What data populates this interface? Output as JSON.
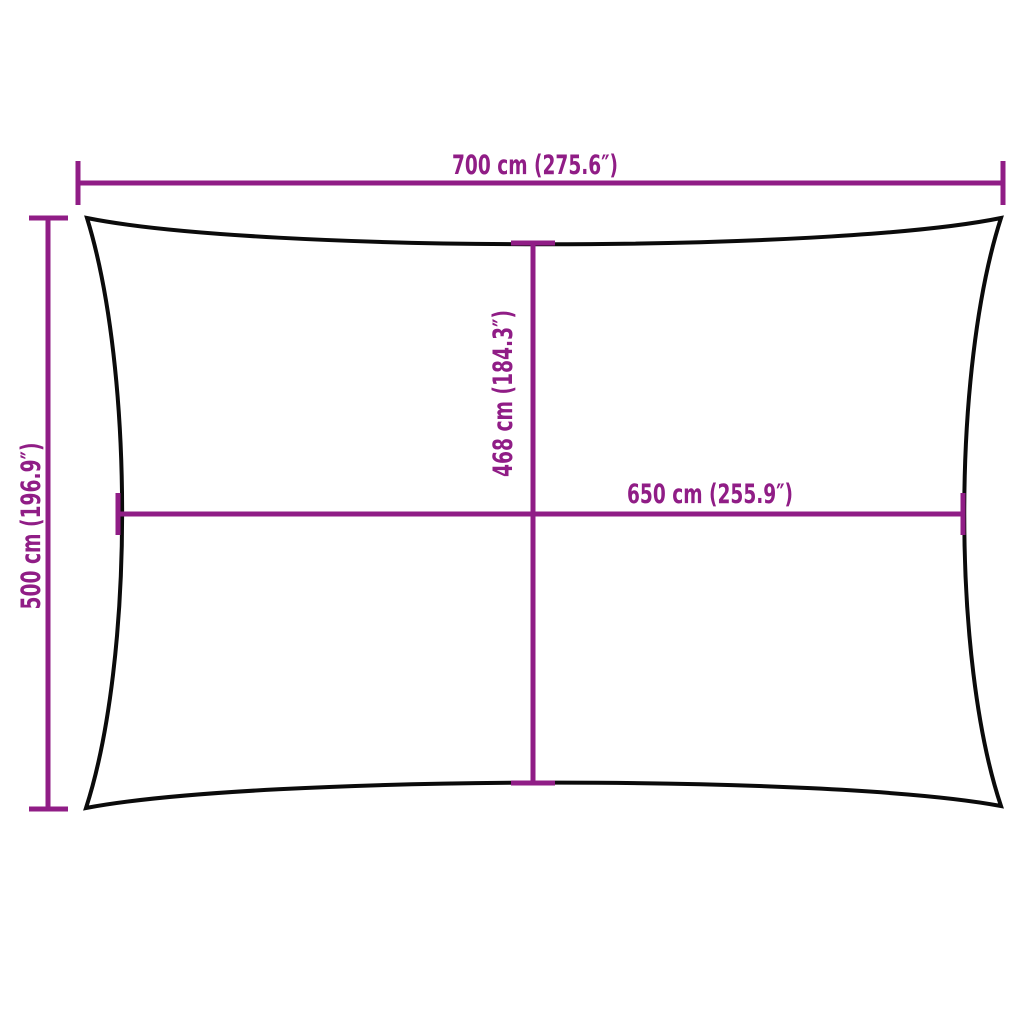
{
  "page": {
    "background": "#ffffff"
  },
  "diagram": {
    "type": "product-dimension-diagram",
    "subject": "rectangular shade sail outline with concave edges",
    "colors": {
      "dimension_lines": "#901d86",
      "sail_outline": "#0b0b0b",
      "background": "#ffffff"
    },
    "dimensions": {
      "top_width": {
        "label": "700 cm (275.6″)",
        "value_cm": 700,
        "value_in": 275.6
      },
      "left_height": {
        "label": "500 cm (196.9″)",
        "value_cm": 500,
        "value_in": 196.9
      },
      "center_height": {
        "label": "468 cm (184.3″)",
        "value_cm": 468,
        "value_in": 184.3
      },
      "center_width": {
        "label": "650 cm (255.9″)",
        "value_cm": 650,
        "value_in": 255.9
      }
    }
  }
}
